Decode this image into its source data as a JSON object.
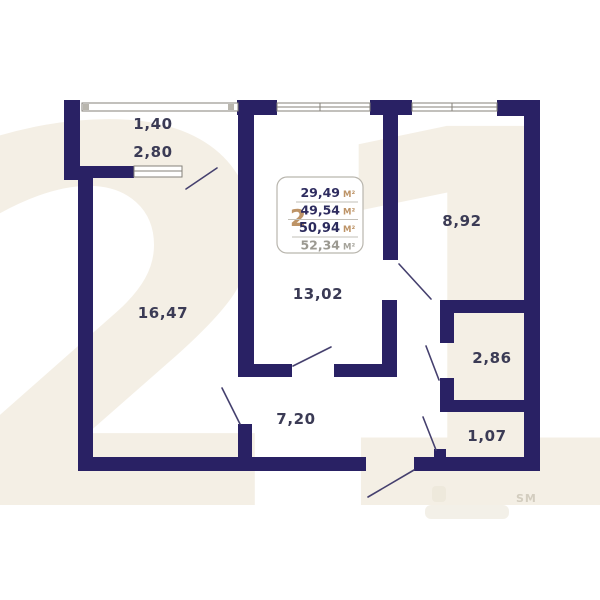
{
  "plan": {
    "watermark": {
      "big_digits": "21",
      "trademark": "SM"
    },
    "info_box": {
      "rooms_count": "2",
      "areas": [
        {
          "value": "29,49",
          "unit": "М²",
          "style": "normal"
        },
        {
          "value": "49,54",
          "unit": "М²",
          "style": "normal"
        },
        {
          "value": "50,94",
          "unit": "М²",
          "style": "bold"
        },
        {
          "value": "52,34",
          "unit": "М²",
          "style": "muted"
        }
      ]
    },
    "rooms": [
      {
        "name": "balcony-width",
        "label": "1,40"
      },
      {
        "name": "balcony-length",
        "label": "2,80"
      },
      {
        "name": "living-room",
        "label": "16,47"
      },
      {
        "name": "bedroom",
        "label": "13,02"
      },
      {
        "name": "kitchen",
        "label": "8,92"
      },
      {
        "name": "bathroom",
        "label": "2,86"
      },
      {
        "name": "hallway",
        "label": "7,20"
      },
      {
        "name": "storage",
        "label": "1,07"
      }
    ],
    "colors": {
      "wall": "#292164",
      "accent_tan": "#bd9366",
      "label_text": "#3b3b55",
      "muted_text": "#9b9991",
      "watermark_beige": "#f4efe5"
    }
  }
}
